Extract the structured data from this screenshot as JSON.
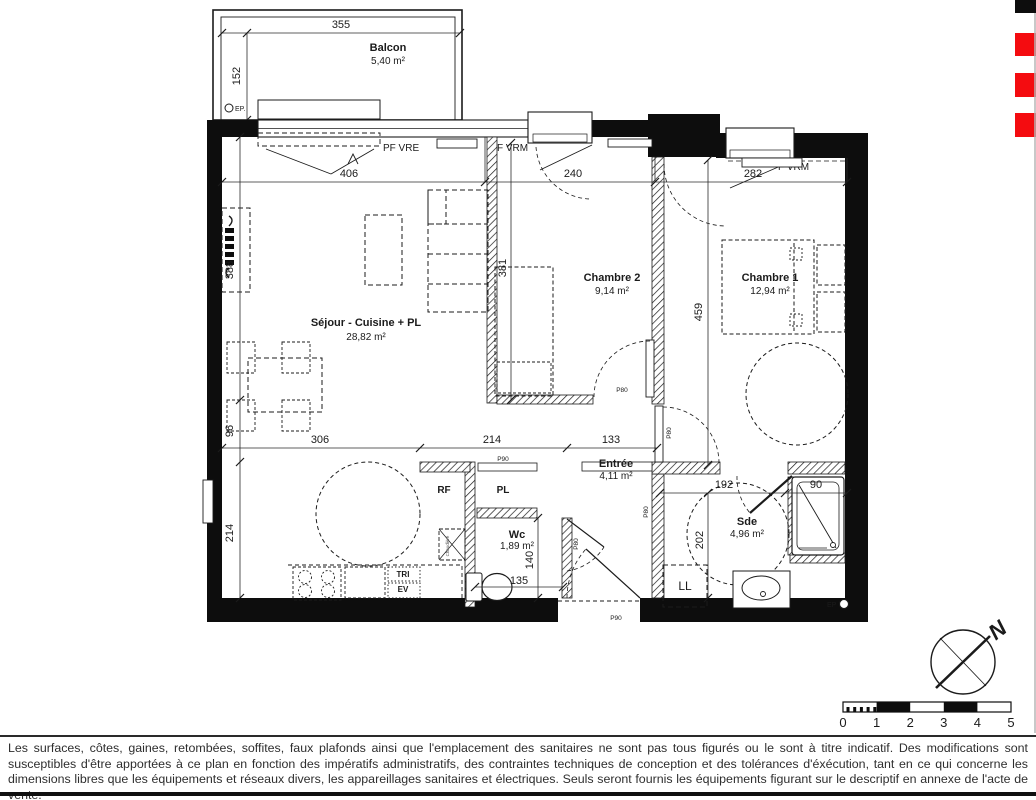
{
  "plan": {
    "rooms": {
      "balcon": {
        "name": "Balcon",
        "area": "5,40 m²"
      },
      "sejour": {
        "name": "Séjour - Cuisine + PL",
        "area": "28,82 m²"
      },
      "chambre2": {
        "name": "Chambre 2",
        "area": "9,14 m²"
      },
      "chambre1": {
        "name": "Chambre 1",
        "area": "12,94 m²"
      },
      "entree": {
        "name": "Entrée",
        "area": "4,11 m²"
      },
      "wc": {
        "name": "Wc",
        "area": "1,89 m²"
      },
      "sde": {
        "name": "Sde",
        "area": "4,96 m²"
      }
    },
    "dimensions": {
      "balcon_w": "355",
      "balcon_h": "152",
      "sejour_w": "406",
      "chambre2_w": "240",
      "chambre1_w": "282",
      "sejour_h": "388",
      "chambre2_h": "381",
      "chambre1_h": "459",
      "kitchen_w": "306",
      "hall_w": "214",
      "entree_w": "133",
      "kitchen_return": "96",
      "left_bottom_h": "214",
      "sde_w": "192",
      "shower_w": "90",
      "sde_h": "202",
      "wc_h": "140",
      "wc_w": "135"
    },
    "openings": {
      "balcony_door": "PF VRE",
      "window_ch2": "F VRM",
      "window_ch1": "F VRM",
      "door_pl": "P90",
      "door_ch2": "P80",
      "door_ch1": "P80",
      "door_wc": "P80",
      "door_sde": "P80",
      "door_entrance": "P90"
    },
    "fixtures": {
      "rf": "RF",
      "pl": "PL",
      "ll": "LL",
      "tri": "TRI",
      "ev": "EV",
      "ep_balcon": "EP.",
      "ep_sde": "EP",
      "chaudiere": "Chaudière"
    },
    "compass": {
      "north": "N"
    },
    "scale": {
      "labels": [
        "0",
        "1",
        "2",
        "3",
        "4",
        "5"
      ]
    }
  },
  "colors": {
    "accent_red": "#F40C10",
    "wall_black": "#0d0d0d"
  },
  "footer": {
    "disclaimer": "Les surfaces, côtes, gaines, retombées, soffites, faux plafonds ainsi que l'emplacement des sanitaires ne sont pas tous figurés ou le sont à titre indicatif. Des modifications sont susceptibles d'être apportées à ce plan en fonction des impératifs administratifs, des contraintes techniques de conception et des tolérances d'éxécution, tant en ce qui concerne les dimensions libres que les équipements et réseaux divers, les appareillages sanitaires et électriques. Seuls seront fournis les équipements figurant sur le descriptif en annexe de l'acte de vente."
  }
}
